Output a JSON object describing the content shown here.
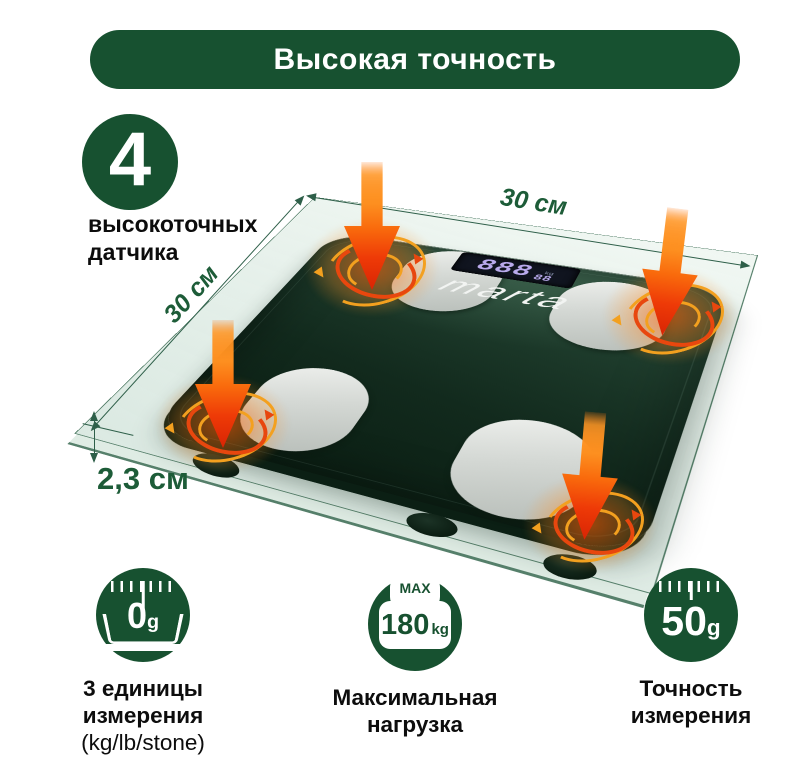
{
  "banner": {
    "title": "Высокая точность"
  },
  "sensors_badge": {
    "value": "4",
    "line1": "высокоточных",
    "line2": "датчика"
  },
  "dimensions": {
    "width": "30 см",
    "depth": "30 см",
    "height": "2,3 см"
  },
  "product": {
    "brand": "marta",
    "lcd": {
      "main": "888",
      "sub": "88",
      "unit": "kg"
    }
  },
  "features": [
    {
      "icon": "scale-units-icon",
      "value": "0",
      "unit": "g",
      "lines": [
        "3 единицы",
        "измерения",
        "(kg/lb/stone)"
      ]
    },
    {
      "icon": "max-load-icon",
      "tag": "MAX",
      "value": "180",
      "unit": "kg",
      "lines": [
        "Максимальная",
        "нагрузка"
      ]
    },
    {
      "icon": "precision-icon",
      "value": "50",
      "unit": "g",
      "lines": [
        "Точность",
        "измерения"
      ]
    }
  ],
  "colors": {
    "brand_green": "#175130",
    "label_green": "#1D5C38",
    "heat_amber": "#F3A01F",
    "heat_red": "#E8470E",
    "scale_dark_green": "#122A1D"
  }
}
